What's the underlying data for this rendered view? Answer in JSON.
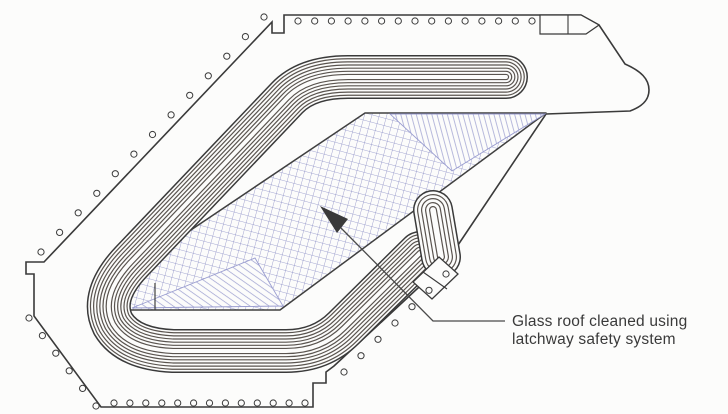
{
  "figure": {
    "description": "Roof plan line drawing with glass roof area and perimeter anchor points",
    "annotation": {
      "lines": [
        "Glass roof cleaned using",
        "latchway safety system"
      ]
    },
    "colors": {
      "background": "#fcfcfb",
      "ink": "#3a3a3a",
      "stripe": "#5a544f",
      "glass_hatch": "#8487c2",
      "triangle_hatch": "#9a9dce",
      "triangle_edge": "#9a9dd0",
      "glass_border": "#404040",
      "leader": "#4a4a4a"
    }
  }
}
